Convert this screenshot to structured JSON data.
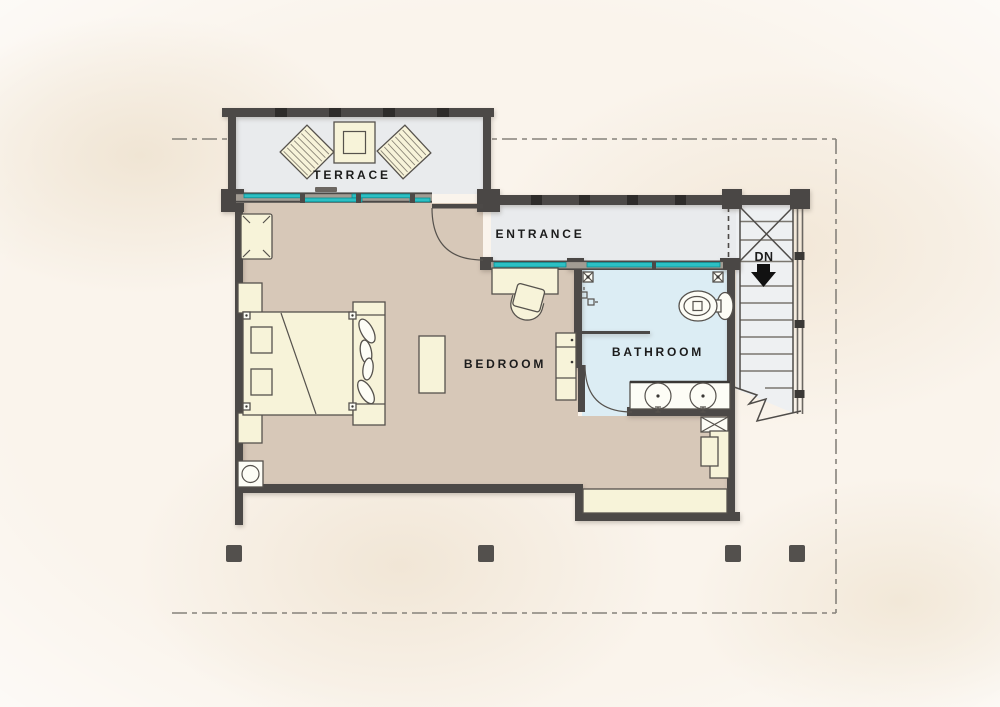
{
  "plan": {
    "rooms": {
      "terrace": {
        "label": "TERRACE"
      },
      "entrance": {
        "label": "ENTRANCE"
      },
      "bedroom": {
        "label": "BEDROOM"
      },
      "bathroom": {
        "label": "BATHROOM"
      }
    },
    "stairs": {
      "direction_label": "DN"
    }
  },
  "colors": {
    "paper": "#faf4ec",
    "paper-blotch": "#f0e5d4",
    "wall": "#4c4947",
    "wall-tick": "#2e2c2a",
    "post": "#4a4745",
    "glazing": "#2cc0c4",
    "glazing-edge": "#0b8e92",
    "frame-gray": "#a29c93",
    "hard-floor": "#e9ebed",
    "bedroom-floor": "#d7c8b8",
    "bathroom-floor": "#dcedf4",
    "stairs-floor": "#eef0f2",
    "furniture": "#f7f3d9",
    "fixture-white": "#fdfdf6",
    "outline": "#56524d",
    "tread": "#7a766f",
    "railing": "#6b6762",
    "dashed-line": "#86827b",
    "column": "#53504d",
    "label-text": "#1c1c1c"
  }
}
